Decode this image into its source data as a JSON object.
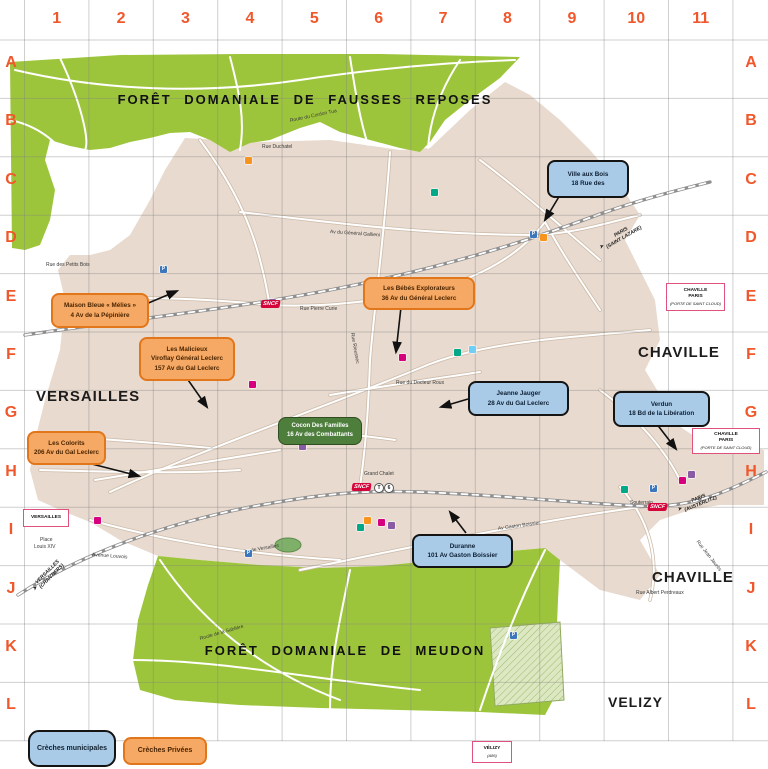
{
  "grid": {
    "columns": [
      "1",
      "2",
      "3",
      "4",
      "5",
      "6",
      "7",
      "8",
      "9",
      "10",
      "11"
    ],
    "rows": [
      "A",
      "B",
      "C",
      "D",
      "E",
      "F",
      "G",
      "H",
      "I",
      "J",
      "K",
      "L"
    ],
    "color": "#F0572B"
  },
  "forest_labels": [
    {
      "text": "FORÊT DOMANIALE DE FAUSSES REPOSES",
      "x": 305,
      "y": 92
    },
    {
      "text": "FORÊT DOMANIALE DE MEUDON",
      "x": 345,
      "y": 643
    }
  ],
  "city_labels": [
    {
      "text": "VERSAILLES",
      "x": 36,
      "y": 388,
      "size": 15
    },
    {
      "text": "CHAVILLE",
      "x": 638,
      "y": 344,
      "size": 15
    },
    {
      "text": "CHAVILLE",
      "x": 652,
      "y": 569,
      "size": 15
    },
    {
      "text": "VELIZY",
      "x": 608,
      "y": 694,
      "size": 14
    }
  ],
  "legend": {
    "municipal": "Crèches municipales",
    "private": "Crèches Privées"
  },
  "creches": [
    {
      "id": "ville-aux-bois",
      "type": "municipal",
      "lines": [
        "Ville aux Bois",
        "18 Rue des"
      ],
      "x": 547,
      "y": 160,
      "w": 78,
      "h": 34
    },
    {
      "id": "maison-bleue-melies",
      "type": "private",
      "lines": [
        "Maison Bleue « Mélies »",
        "4 Av de la Pépinière"
      ],
      "x": 51,
      "y": 293,
      "w": 94,
      "h": 31
    },
    {
      "id": "les-malicieux",
      "type": "private",
      "lines": [
        "Les Malicieux",
        "Viroflay Général Leclerc",
        "157 Av du Gal Leclerc"
      ],
      "x": 139,
      "y": 337,
      "w": 92,
      "h": 40
    },
    {
      "id": "les-bebes-explorateurs",
      "type": "private",
      "lines": [
        "Les Bébés Explorateurs",
        "36 Av du Général Leclerc"
      ],
      "x": 363,
      "y": 277,
      "w": 108,
      "h": 29
    },
    {
      "id": "jeanne-jauger",
      "type": "municipal",
      "lines": [
        "Jeanne Jauger",
        "28 Av du Gal Leclerc"
      ],
      "x": 468,
      "y": 381,
      "w": 97,
      "h": 31
    },
    {
      "id": "verdun",
      "type": "municipal",
      "lines": [
        "Verdun",
        "18 Bd de la Libération"
      ],
      "x": 613,
      "y": 391,
      "w": 93,
      "h": 32
    },
    {
      "id": "cocon-des-familles",
      "type": "green",
      "lines": [
        "Cocon Des Familles",
        "16 Av des Combattants"
      ],
      "x": 278,
      "y": 417,
      "w": 82,
      "h": 26
    },
    {
      "id": "les-colorits",
      "type": "private",
      "lines": [
        "Les Colorits",
        "206 Av du Gal Leclerc"
      ],
      "x": 27,
      "y": 431,
      "w": 75,
      "h": 30
    },
    {
      "id": "duranne",
      "type": "municipal",
      "lines": [
        "Duranne",
        "101 Av Gaston Boissier"
      ],
      "x": 412,
      "y": 534,
      "w": 97,
      "h": 30
    }
  ],
  "arrows": [
    [
      560,
      195,
      545,
      220
    ],
    [
      146,
      304,
      177,
      291
    ],
    [
      186,
      377,
      207,
      407
    ],
    [
      401,
      307,
      396,
      352
    ],
    [
      468,
      399,
      441,
      407
    ],
    [
      656,
      423,
      676,
      449
    ],
    [
      80,
      461,
      139,
      476
    ],
    [
      466,
      533,
      450,
      512
    ]
  ],
  "station_boxes": [
    {
      "lines": [
        "CHAVILLE",
        "PARIS",
        "(PORTE DE SAINT CLOUD)"
      ],
      "x": 666,
      "y": 283,
      "w": 57,
      "h": 26
    },
    {
      "lines": [
        "CHAVILLE",
        "PARIS",
        "(PORTE DE SAINT CLOUD)"
      ],
      "x": 692,
      "y": 428,
      "w": 66,
      "h": 24
    },
    {
      "lines": [
        "VERSAILLES"
      ],
      "x": 23,
      "y": 509,
      "w": 44,
      "h": 16
    },
    {
      "lines": [
        "VÉLIZY",
        "(A86)"
      ],
      "x": 472,
      "y": 741,
      "w": 38,
      "h": 20
    }
  ],
  "rail_labels": [
    {
      "text": "PARIS",
      "text2": "(SAINT LAZARE)",
      "x": 600,
      "y": 242,
      "rot": -30
    },
    {
      "text": "PARIS",
      "text2": "(AUSTERLITZ)",
      "x": 678,
      "y": 504,
      "rot": -22
    },
    {
      "text": "VERSAILLES",
      "text2": "(CHANTIERS)",
      "x": 34,
      "y": 584,
      "rot": -45
    }
  ],
  "arrow_glyph": "➤",
  "sncf_label": "SNCF",
  "sncf_logos": [
    {
      "x": 261,
      "y": 300
    },
    {
      "x": 352,
      "y": 483
    },
    {
      "x": 648,
      "y": 503
    }
  ],
  "tram_badges": [
    {
      "glyph": "T",
      "x": 374,
      "y": 483
    },
    {
      "glyph": "6",
      "x": 384,
      "y": 483
    }
  ],
  "street_labels": [
    {
      "text": "Rue Duchatel",
      "x": 262,
      "y": 144,
      "rot": 0
    },
    {
      "text": "Route du Cordon Tua",
      "x": 290,
      "y": 118,
      "rot": -12
    },
    {
      "text": "Rue des Petits Bois",
      "x": 46,
      "y": 262,
      "rot": 0
    },
    {
      "text": "Rue Pierre Curie",
      "x": 300,
      "y": 306,
      "rot": 0
    },
    {
      "text": "Av du Général Gallieni",
      "x": 330,
      "y": 229,
      "rot": 4
    },
    {
      "text": "Rue Rieussec",
      "x": 352,
      "y": 330,
      "rot": 80
    },
    {
      "text": "Rue du Docteur Roux",
      "x": 396,
      "y": 380,
      "rot": 0
    },
    {
      "text": "Place",
      "x": 40,
      "y": 537,
      "rot": 0
    },
    {
      "text": "Louis XIV",
      "x": 34,
      "y": 544,
      "rot": 0
    },
    {
      "text": "Avenue Louvois",
      "x": 92,
      "y": 552,
      "rot": 4
    },
    {
      "text": "Av de Versailles",
      "x": 244,
      "y": 549,
      "rot": -10
    },
    {
      "text": "Grand Chalet",
      "x": 364,
      "y": 471,
      "rot": 0
    },
    {
      "text": "Souterrain",
      "x": 630,
      "y": 500,
      "rot": 0
    },
    {
      "text": "Rue Jean Jaurès",
      "x": 697,
      "y": 538,
      "rot": 52
    },
    {
      "text": "Rue Albert Perdreaux",
      "x": 636,
      "y": 590,
      "rot": 0
    },
    {
      "text": "Route de la Sablière",
      "x": 200,
      "y": 636,
      "rot": -16
    },
    {
      "text": "Av Gaston Boissier",
      "x": 498,
      "y": 526,
      "rot": -8
    }
  ],
  "markers": [
    {
      "x": 160,
      "y": 266,
      "c": "#3C76BC",
      "g": "P"
    },
    {
      "x": 245,
      "y": 550,
      "c": "#3C76BC",
      "g": "P"
    },
    {
      "x": 510,
      "y": 632,
      "c": "#3C76BC",
      "g": "P"
    },
    {
      "x": 650,
      "y": 485,
      "c": "#3C76BC",
      "g": "P"
    },
    {
      "x": 530,
      "y": 231,
      "c": "#3C76BC",
      "g": "P"
    },
    {
      "x": 540,
      "y": 234,
      "c": "#F7941D",
      "g": ""
    },
    {
      "x": 378,
      "y": 519,
      "c": "#D6007F",
      "g": ""
    },
    {
      "x": 388,
      "y": 522,
      "c": "#8A5BA5",
      "g": ""
    },
    {
      "x": 364,
      "y": 517,
      "c": "#F7941D",
      "g": ""
    },
    {
      "x": 357,
      "y": 524,
      "c": "#00A887",
      "g": ""
    },
    {
      "x": 269,
      "y": 299,
      "c": "#8A5BA5",
      "g": ""
    },
    {
      "x": 399,
      "y": 354,
      "c": "#D6007F",
      "g": ""
    },
    {
      "x": 454,
      "y": 349,
      "c": "#00A887",
      "g": ""
    },
    {
      "x": 469,
      "y": 346,
      "c": "#6DCFF6",
      "g": ""
    },
    {
      "x": 249,
      "y": 381,
      "c": "#D6007F",
      "g": ""
    },
    {
      "x": 299,
      "y": 443,
      "c": "#8A5BA5",
      "g": ""
    },
    {
      "x": 94,
      "y": 517,
      "c": "#D6007F",
      "g": ""
    },
    {
      "x": 431,
      "y": 189,
      "c": "#00A887",
      "g": ""
    },
    {
      "x": 245,
      "y": 157,
      "c": "#F7941D",
      "g": ""
    },
    {
      "x": 679,
      "y": 477,
      "c": "#D6007F",
      "g": ""
    },
    {
      "x": 688,
      "y": 471,
      "c": "#8A5BA5",
      "g": ""
    },
    {
      "x": 621,
      "y": 486,
      "c": "#00A887",
      "g": ""
    }
  ],
  "colors": {
    "forest_green": "#9DC53C",
    "urban_beige": "#E8DACE",
    "hatch_parcel": "#DCE8C2",
    "grid_label": "#F0572B",
    "station_border": "#E0517E",
    "sncf_red": "#D5053C"
  }
}
